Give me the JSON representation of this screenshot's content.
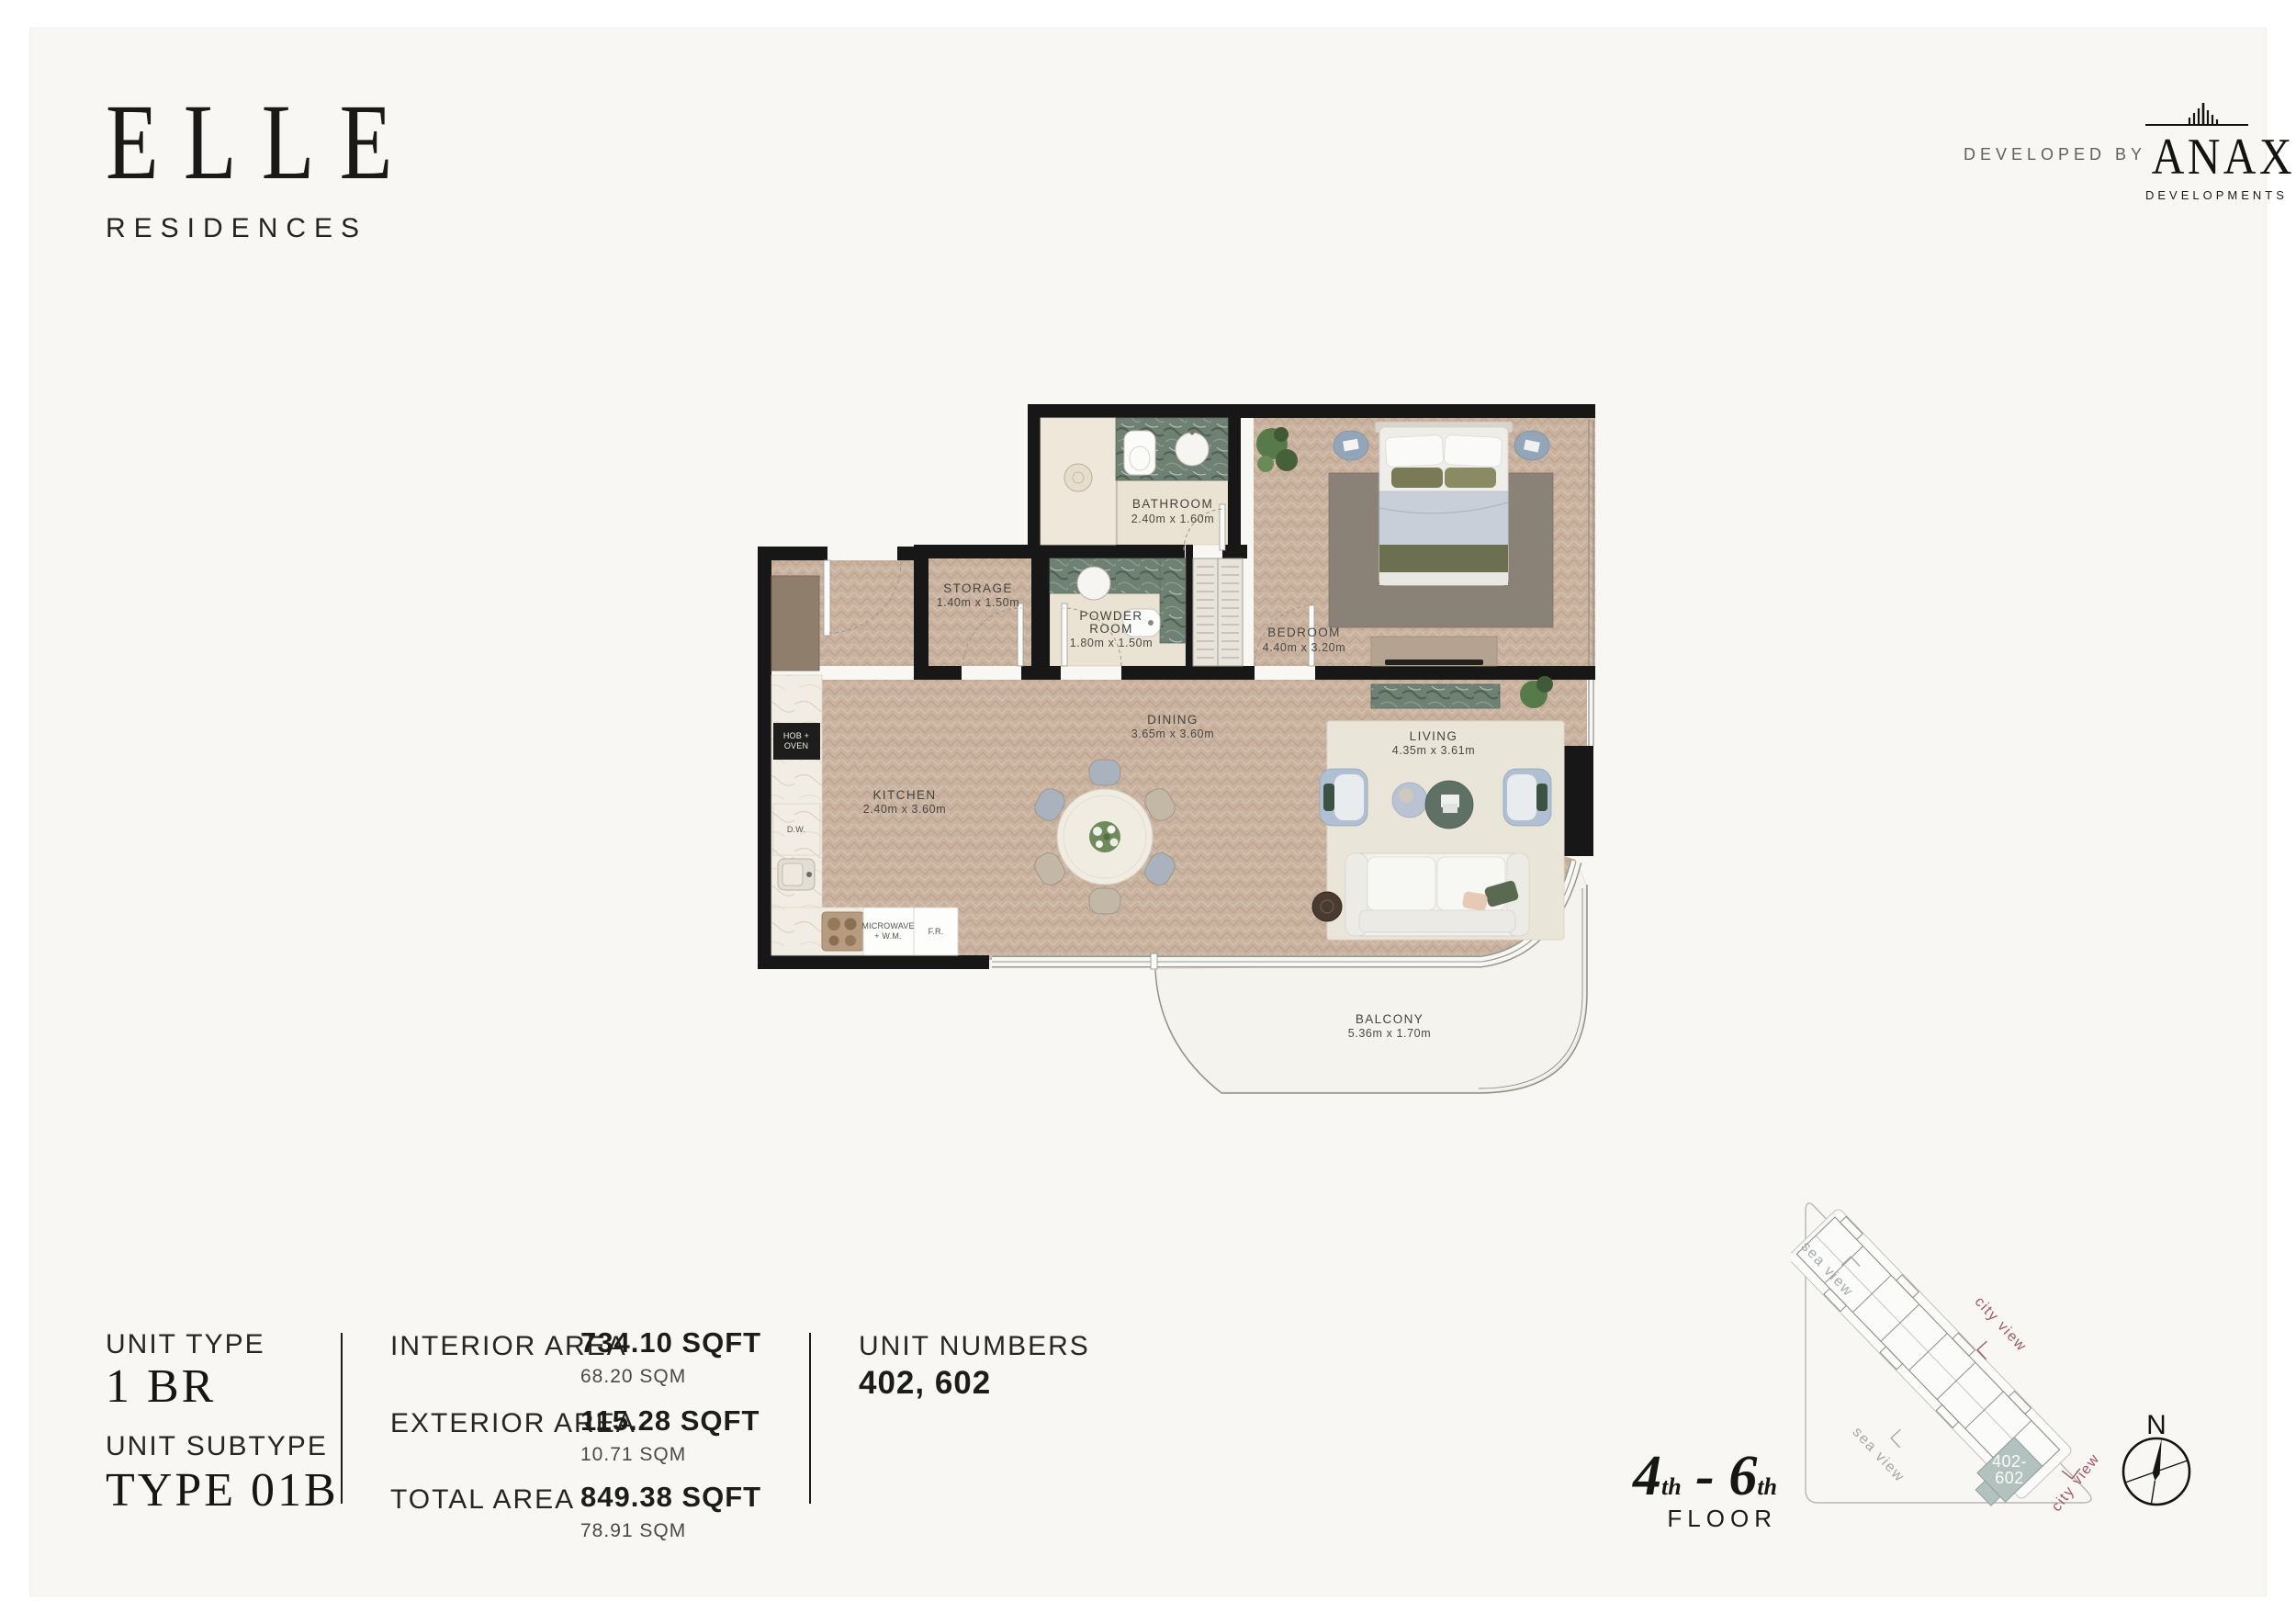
{
  "brand": {
    "logo_main": "ELLE",
    "logo_sub": "RESIDENCES"
  },
  "developer": {
    "prefix": "DEVELOPED BY",
    "name": "ANAX",
    "suffix": "DEVELOPMENTS"
  },
  "plan": {
    "bathroom": {
      "name": "BATHROOM",
      "dims": "2.40m x 1.60m"
    },
    "storage": {
      "name": "STORAGE",
      "dims": "1.40m x 1.50m"
    },
    "powder": {
      "name1": "POWDER",
      "name2": "ROOM",
      "dims": "1.80m x 1.50m"
    },
    "bedroom": {
      "name": "BEDROOM",
      "dims": "4.40m x 3.20m"
    },
    "dining": {
      "name": "DINING",
      "dims": "3.65m x 3.60m"
    },
    "kitchen": {
      "name": "KITCHEN",
      "dims": "2.40m x 3.60m"
    },
    "living": {
      "name": "LIVING",
      "dims": "4.35m x 3.61m"
    },
    "balcony": {
      "name": "BALCONY",
      "dims": "5.36m x 1.70m"
    },
    "appliances": {
      "hob1": "HOB +",
      "hob2": "OVEN",
      "dw": "D.W.",
      "mw1": "MICROWAVE",
      "mw2": "+ W.M.",
      "fr": "F.R."
    }
  },
  "info": {
    "unit_type_label": "UNIT TYPE",
    "unit_type_value": "1 BR",
    "unit_subtype_label": "UNIT SUBTYPE",
    "unit_subtype_value": "TYPE 01B",
    "areas": [
      {
        "label": "INTERIOR AREA",
        "sqft": "734.10 SQFT",
        "sqm": "68.20 SQM"
      },
      {
        "label": "EXTERIOR AREA",
        "sqft": "115.28 SQFT",
        "sqm": "10.71 SQM"
      },
      {
        "label": "TOTAL AREA",
        "sqft": "849.38 SQFT",
        "sqm": "78.91 SQM"
      }
    ],
    "unit_numbers_label": "UNIT NUMBERS",
    "unit_numbers_value": "402, 602"
  },
  "floor": {
    "n1": "4",
    "s1": "th",
    "sep": " - ",
    "n2": "6",
    "s2": "th",
    "word": "FLOOR"
  },
  "sitemap": {
    "sea_view": "sea view",
    "city_view": "city view",
    "unit_line1": "402-",
    "unit_line2": "602",
    "compass": "N"
  },
  "colors": {
    "city_view": "#a25862",
    "sea_view": "#9fadaa",
    "sea_view_2": "#a6a6a2",
    "unit_highlight": "#b3c1bf",
    "wall": "#171717"
  }
}
